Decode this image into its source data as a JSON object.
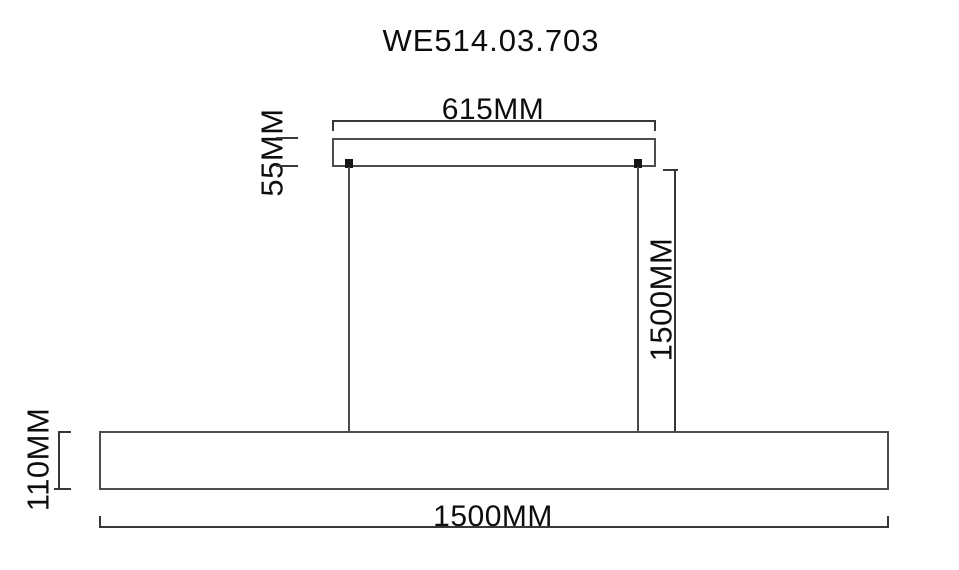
{
  "product_code": "WE514.03.703",
  "drawing": {
    "type": "technical-dimension-diagram",
    "subject": "linear-pendant-lamp-front-elevation",
    "labels": {
      "canopy_width": "615MM",
      "canopy_height": "55MM",
      "drop_length": "1500MM",
      "bar_height": "110MM",
      "bar_width": "1500MM"
    },
    "colors": {
      "background": "#ffffff",
      "dimension_line": "#383838",
      "outline": "#4d4d4d",
      "text": "#0d0d0d"
    }
  }
}
